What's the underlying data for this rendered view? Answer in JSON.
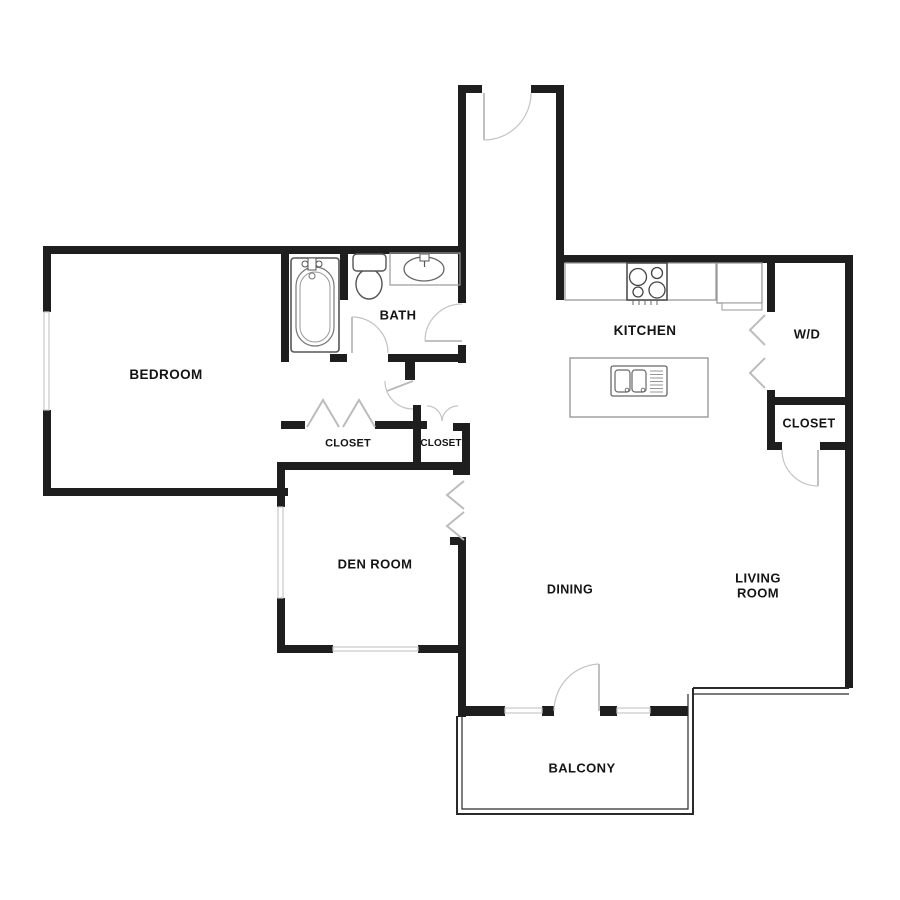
{
  "floor_plan": {
    "background_color": "#ffffff",
    "wall_color": "#1e1e1e",
    "window_color": "#c8c8c8",
    "door_arc_color": "#c4c4c4",
    "fixture_color": "#666666",
    "label_color": "#141414",
    "rooms": {
      "bedroom": {
        "label": "BEDROOM"
      },
      "bath": {
        "label": "BATH"
      },
      "kitchen": {
        "label": "KITCHEN"
      },
      "washer_dryer": {
        "label": "W/D"
      },
      "closet_hall_left": {
        "label": "CLOSET"
      },
      "closet_hall_right": {
        "label": "CLOSET"
      },
      "closet_living_room": {
        "label": "CLOSET"
      },
      "den": {
        "label": "DEN ROOM"
      },
      "dining": {
        "label": "DINING"
      },
      "living_room": {
        "label": "LIVING ROOM"
      },
      "balcony": {
        "label": "BALCONY"
      }
    },
    "fixtures": [
      "bathtub",
      "toilet",
      "bathroom-sink",
      "kitchen-counter",
      "stove",
      "refrigerator",
      "kitchen-island",
      "island-sink"
    ],
    "features": [
      "entry-door",
      "bath-doors",
      "bifold-closet-doors",
      "double-closet-doors",
      "windows",
      "balcony-door",
      "balcony"
    ]
  }
}
